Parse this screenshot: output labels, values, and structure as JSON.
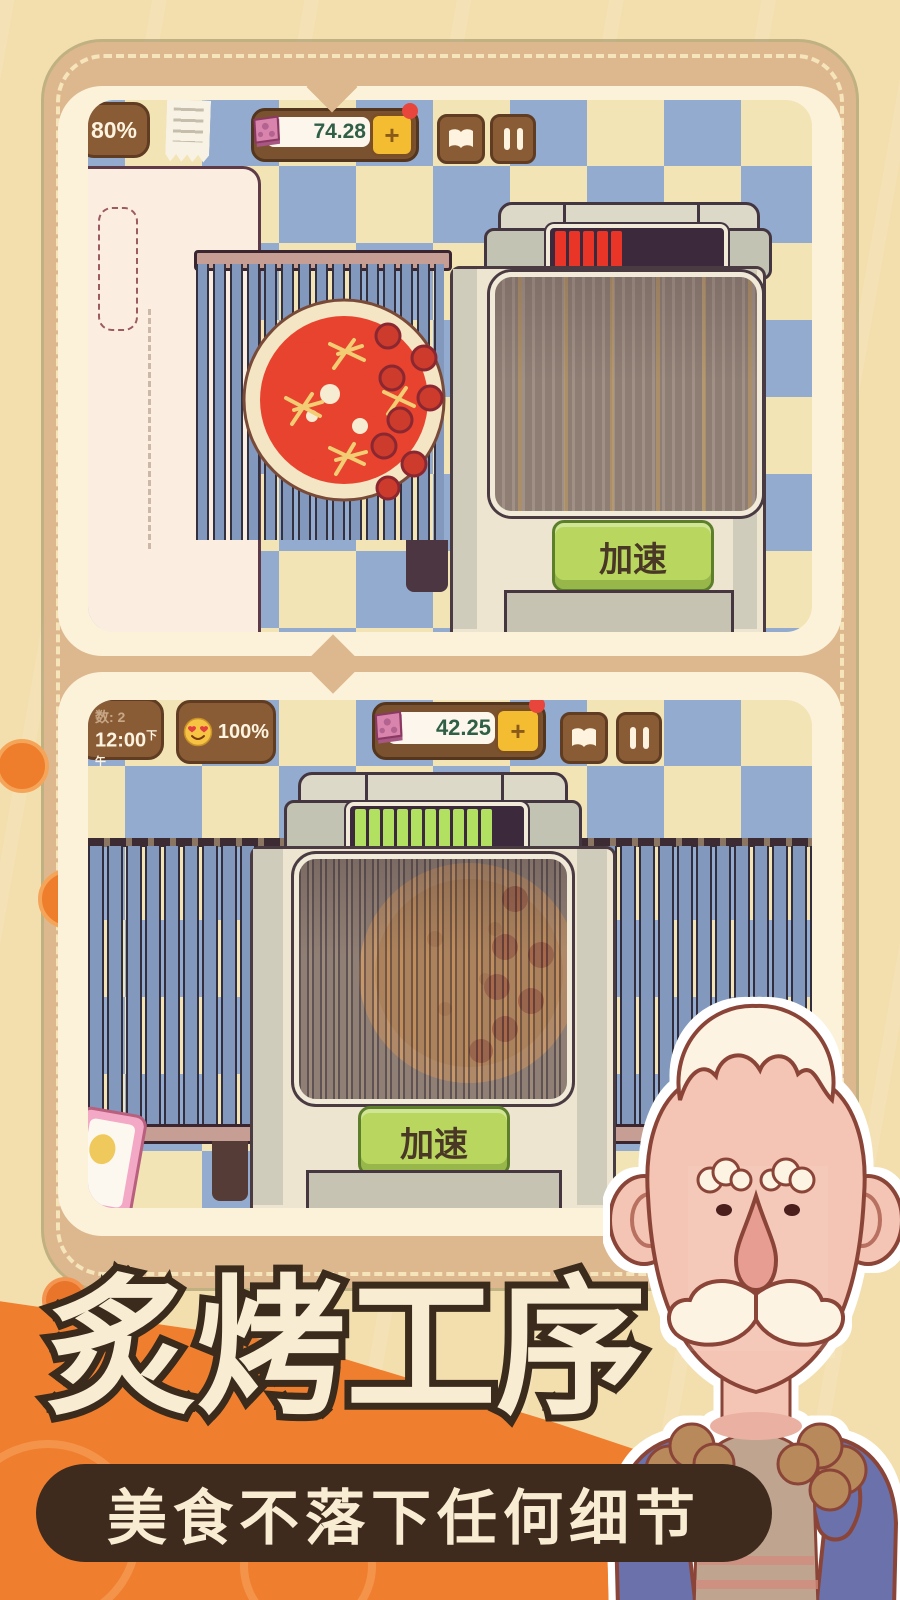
{
  "colors": {
    "background": "#f3dfae",
    "frame_tan": "#ddb88e",
    "card_cream": "#fcf2d9",
    "checker_blue": "#93abce",
    "checker_cream": "#f2e4b4",
    "ui_brown": "#8a5c36",
    "money_text": "#2f5f47",
    "plus_yellow": "#f4bd31",
    "alert_red": "#e8453c",
    "progress_red": "#e93528",
    "progress_green": "#b2e061",
    "speed_green": "#b9d75f",
    "orange_accent": "#ef7f2e",
    "title_fill": "#f8ecd2",
    "title_outline": "#3a2b1c",
    "subtitle_bg": "#3f2b1e"
  },
  "panel1": {
    "satisfaction": "80%",
    "money": "74.28",
    "plus_label": "+",
    "speed_button": "加速",
    "progress": {
      "filled": 5,
      "total": 12,
      "color": "#e93528",
      "off_color": "#3c2a3c"
    }
  },
  "panel2": {
    "day_label": "数: 2",
    "time": "12:00",
    "time_suffix": "下午",
    "mood_percent": "100%",
    "money": "42.25",
    "plus_label": "+",
    "speed_button": "加速",
    "progress": {
      "filled": 10,
      "total": 12,
      "color": "#b2e061",
      "off_color": "#3c2a3c"
    }
  },
  "footer": {
    "title": "炙烤工序",
    "subtitle": "美食不落下任何细节"
  },
  "icons": {
    "receipt": "receipt",
    "book": "recipe-book",
    "pause": "pause",
    "coin": "pizza-coin",
    "mood": "heart-eyes-emoji"
  }
}
